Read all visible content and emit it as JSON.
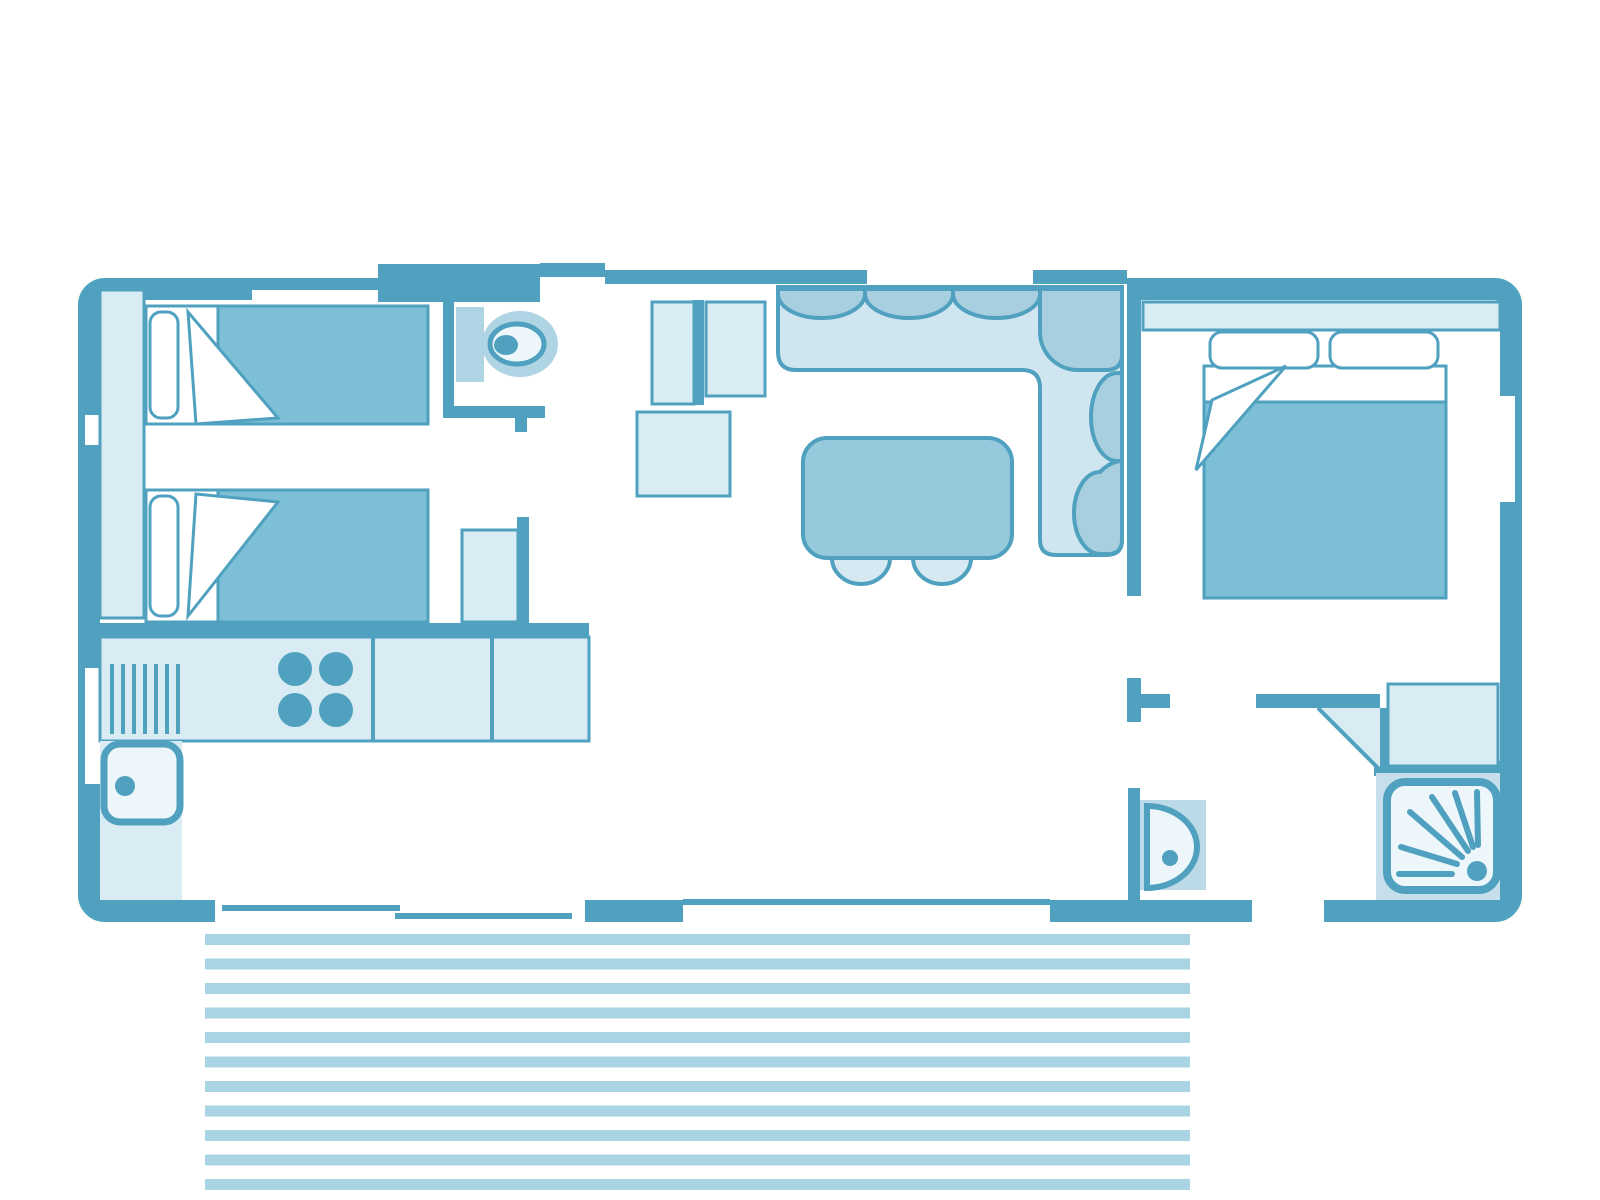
{
  "palette": {
    "wall": "#4FA1BF",
    "mid": "#7DBFD6",
    "table": "#97C9DC",
    "seat": "#CFE5F0",
    "cushion": "#A8CFE0",
    "light": "#D9ECF4",
    "stool": "#D6E9F3",
    "fixture": "#AFD4E4",
    "fixlight": "#EDF6FA",
    "basin": "#BCD9E8",
    "shower": "#C7DFEC",
    "stripe": "#A9D4E4",
    "paper": "#FFFFFF"
  },
  "terrace": {
    "x": 205,
    "width": 985,
    "first_y": 934,
    "period": 24.5,
    "height": 11,
    "count": 11
  },
  "inventory": {
    "rooms": [
      {
        "name": "twin-bedroom"
      },
      {
        "name": "wc"
      },
      {
        "name": "kitchen"
      },
      {
        "name": "living-dining-room"
      },
      {
        "name": "hallway"
      },
      {
        "name": "master-bedroom"
      },
      {
        "name": "shower-room"
      },
      {
        "name": "terrace-decking"
      }
    ],
    "furniture": [
      {
        "name": "single-bed",
        "count": 2
      },
      {
        "name": "wardrobe-strip"
      },
      {
        "name": "toilet"
      },
      {
        "name": "storage-cabinet",
        "count": 4
      },
      {
        "name": "kitchen-counter"
      },
      {
        "name": "hob-4-burners"
      },
      {
        "name": "draining-board"
      },
      {
        "name": "kitchen-sink"
      },
      {
        "name": "corner-sofa"
      },
      {
        "name": "dining-table"
      },
      {
        "name": "stool",
        "count": 2
      },
      {
        "name": "double-bed"
      },
      {
        "name": "master-wardrobe"
      },
      {
        "name": "washbasin"
      },
      {
        "name": "shower-tray"
      },
      {
        "name": "sliding-patio-door"
      },
      {
        "name": "bay-window"
      },
      {
        "name": "entrance-door"
      }
    ]
  }
}
